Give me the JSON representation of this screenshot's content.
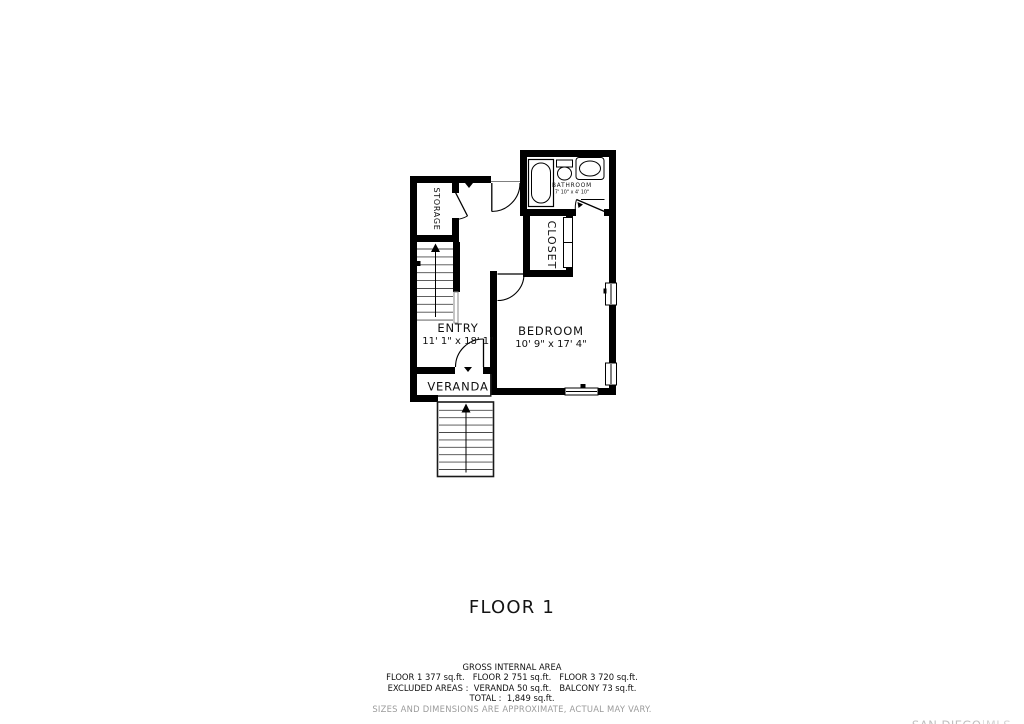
{
  "title": "FLOOR 1",
  "floor_plan": {
    "rooms": {
      "storage": {
        "label": "STORAGE"
      },
      "entry": {
        "label": "ENTRY",
        "dimensions": "11' 1\" x 18' 1\""
      },
      "bedroom": {
        "label": "BEDROOM",
        "dimensions": "10' 9\" x 17' 4\""
      },
      "closet": {
        "label": "CLOSET"
      },
      "bathroom": {
        "label": "BATHROOM",
        "dimensions": "7' 10\" x 4' 10\""
      },
      "veranda": {
        "label": "VERANDA"
      }
    }
  },
  "summary": {
    "heading": "GROSS INTERNAL AREA",
    "floors_line": "FLOOR 1 377 sq.ft.   FLOOR 2 751 sq.ft.   FLOOR 3 720 sq.ft.",
    "excluded_line": "EXCLUDED AREAS :  VERANDA 50 sq.ft.   BALCONY 73 sq.ft.",
    "total_line": "TOTAL :  1,849 sq.ft.",
    "disclaimer": "SIZES AND DIMENSIONS ARE APPROXIMATE, ACTUAL MAY VARY."
  },
  "watermark": {
    "brand": "SAN DIEGO",
    "divider": "|",
    "suffix": "MLS"
  },
  "colors": {
    "wall": "#000000",
    "text": "#111111",
    "disclaimer_gray": "#9b9b9b",
    "watermark_gray": "#c6c6c6"
  }
}
